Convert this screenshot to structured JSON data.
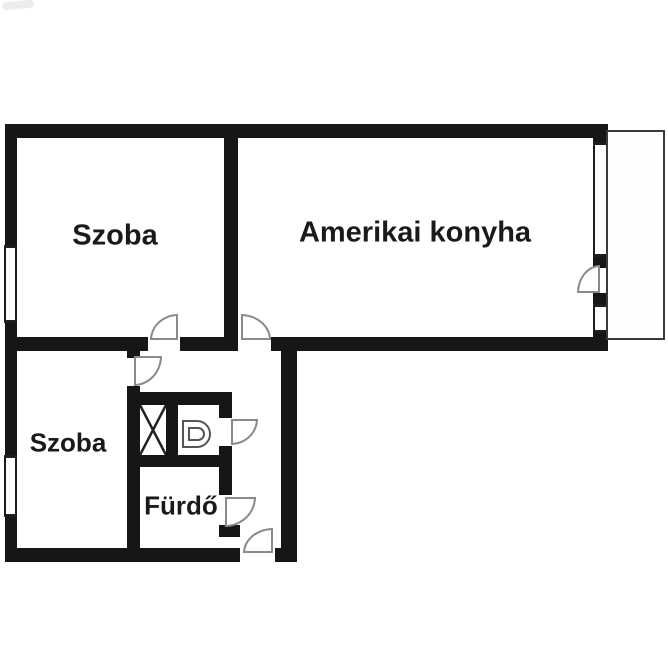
{
  "floorplan": {
    "rooms": [
      {
        "id": "room-upper-left",
        "label": "Szoba"
      },
      {
        "id": "american-kitchen",
        "label": "Amerikai konyha"
      },
      {
        "id": "room-lower-left",
        "label": "Szoba"
      },
      {
        "id": "bathroom",
        "label": "Fürdő"
      }
    ],
    "colors": {
      "wall": "#161616",
      "background": "#ffffff",
      "door_arc": "#8a8a8a",
      "text": "#1a1a1a"
    },
    "symbols": [
      "window-double-line",
      "door-swing-arc",
      "toilet-top-view",
      "wardrobe-x-box",
      "balcony-thin-outline"
    ]
  }
}
